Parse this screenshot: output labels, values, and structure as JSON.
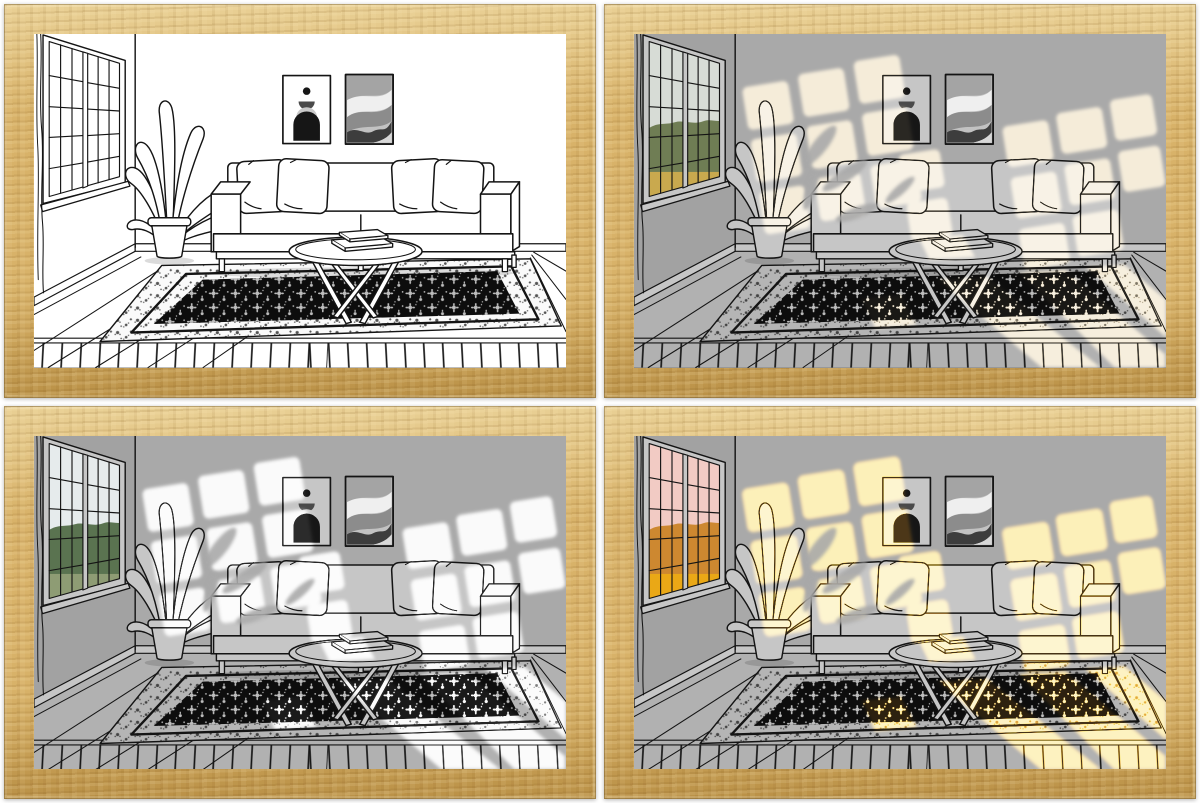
{
  "title": "wood-framed living-room line-art light painting shown in four lighting modes",
  "grid": {
    "rows": 2,
    "cols": 2
  },
  "theme": {
    "vars": {
      "--page": "#ffffff",
      "--wood": "#d8b269",
      "--wood-l": "#e9d095",
      "--wood-d": "#ba9147",
      "--line": "#141414"
    }
  },
  "scene": {
    "elements": [
      "window-with-grid-panes",
      "potted-plant",
      "two-abstract-posters",
      "sofa-with-four-pillows",
      "round-coffee-table-with-books",
      "oriental-rug",
      "plank-floor"
    ],
    "rug_field_color": "#0d0d0d",
    "rug_motif_light": "#bdbdbd",
    "poster_arch_color": "#161616",
    "poster_wave_darks": "#3d3d3d"
  },
  "panels": [
    {
      "name": "panel-1 line art, light off, white background",
      "vars": {
        "--wall": "#ffffff",
        "--wallL": "#ffffff",
        "--floor": "#ffffff",
        "--paper": "#ffffff",
        "--rugband": "#fafafa",
        "--vsky": "#ffffff",
        "--vtree": "#ffffff",
        "--vfield": "#ffffff",
        "--light": "#ffffff",
        "--light2": "transparent",
        "--lightsOn": "0"
      }
    },
    {
      "name": "panel-2 gray scene with warm cream daylight through window",
      "vars": {
        "--wall": "#a9a9a9",
        "--wallL": "#a2a2a2",
        "--floor": "#b1b1b1",
        "--paper": "#c6c6c6",
        "--rugband": "#b5b5b5",
        "--vsky": "#d7dcd6",
        "--vtree": "#6f7d54",
        "--vfield": "#c9a94e",
        "--light": "#f7e9cc",
        "--light2": "transparent",
        "--lightsOn": "1"
      }
    },
    {
      "name": "panel-3 gray scene with bright white light through window",
      "vars": {
        "--wall": "#a9a9a9",
        "--wallL": "#a2a2a2",
        "--floor": "#b1b1b1",
        "--paper": "#c6c6c6",
        "--rugband": "#b5b5b5",
        "--vsky": "#e6ebec",
        "--vtree": "#5a7350",
        "--vfield": "#8e9c74",
        "--light": "#ffffff",
        "--light2": "transparent",
        "--lightsOn": "1"
      }
    },
    {
      "name": "panel-4 gray scene with golden-hour sunlight through window",
      "vars": {
        "--wall": "#a9a9a9",
        "--wallL": "#a2a2a2",
        "--floor": "#b1b1b1",
        "--paper": "#c6c6c6",
        "--rugband": "#b5b5b5",
        "--vsky": "#f2cbc4",
        "--vtree": "#cd8830",
        "--vfield": "#eaa816",
        "--light": "#f2bd62",
        "--light2": "#ffe9b2",
        "--lightsOn": "1"
      }
    }
  ]
}
